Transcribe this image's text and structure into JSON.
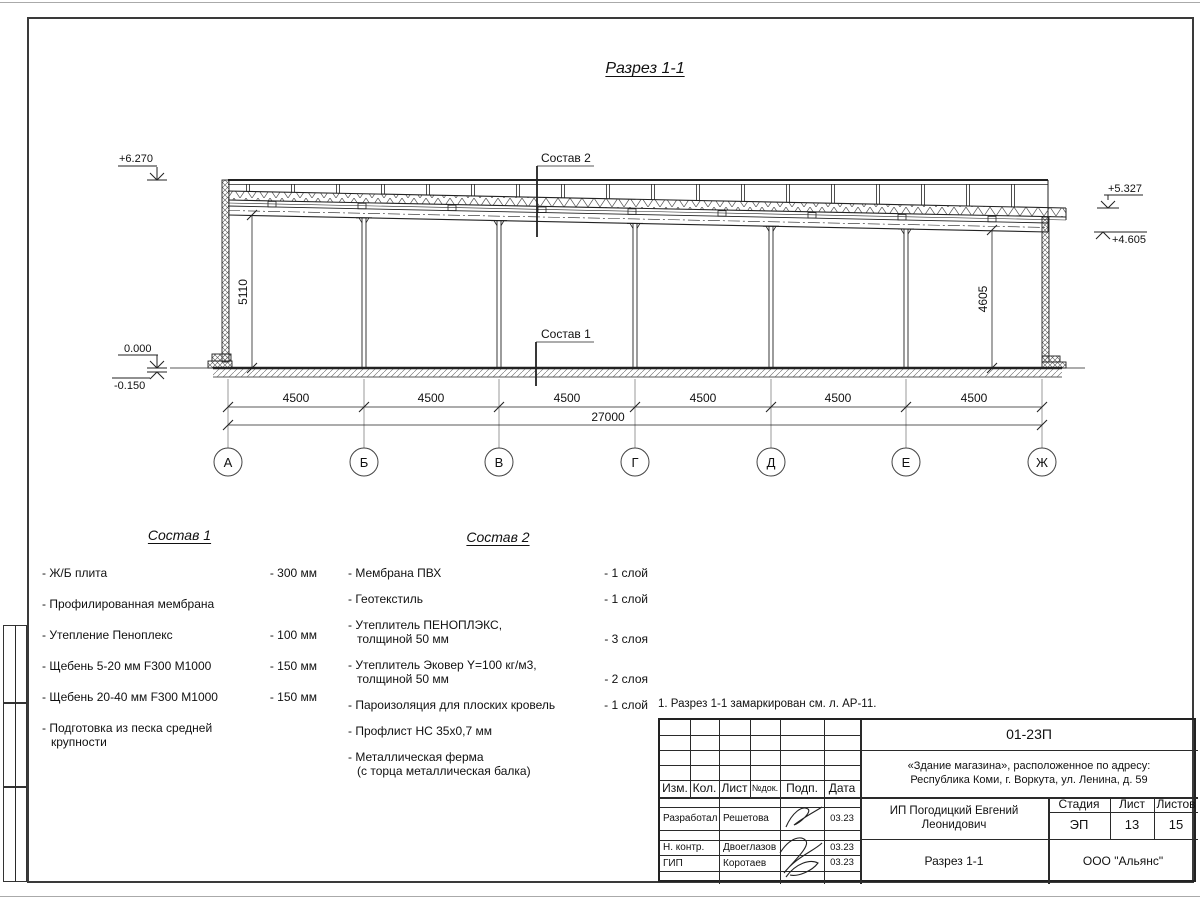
{
  "title": "Разрез 1-1",
  "section": {
    "leader1": "Состав 1",
    "leader2": "Состав 2",
    "elevations": {
      "top_left": "+6.270",
      "zero": "0.000",
      "minus": "-0.150",
      "right_upper": "+5.327",
      "right_lower": "+4.605"
    },
    "dims": {
      "bays": [
        "4500",
        "4500",
        "4500",
        "4500",
        "4500",
        "4500"
      ],
      "total": "27000",
      "height_left": "5110",
      "height_right": "4605"
    },
    "axes": [
      "А",
      "Б",
      "В",
      "Г",
      "Д",
      "Е",
      "Ж"
    ]
  },
  "sostav1": {
    "heading": "Состав 1",
    "items": [
      {
        "text": "- Ж/Б плита",
        "value": "- 300 мм"
      },
      {
        "text": "- Профилированная мембрана",
        "value": ""
      },
      {
        "text": "- Утепление Пеноплекс",
        "value": "- 100 мм"
      },
      {
        "text": "-  Щебень 5-20 мм F300 М1000",
        "value": "- 150 мм"
      },
      {
        "text": "-  Щебень 20-40 мм F300 М1000",
        "value": "- 150 мм"
      },
      {
        "text": "- Подготовка из песка средней\nкрупности",
        "value": ""
      }
    ]
  },
  "sostav2": {
    "heading": "Состав 2",
    "items": [
      {
        "text": "- Мембрана ПВХ",
        "value": "- 1 слой"
      },
      {
        "text": "- Геотекстиль",
        "value": "- 1 слой"
      },
      {
        "text": "- Утеплитель ПЕНОПЛЭКС,\nтолщиной 50 мм",
        "value": "- 3 слоя"
      },
      {
        "text": "- Утеплитель Эковер Y=100 кг/м3,\nтолщиной 50 мм",
        "value": "- 2 слоя"
      },
      {
        "text": "- Пароизоляция для плоских кровель",
        "value": "- 1 слой"
      },
      {
        "text": "- Профлист НС 35х0,7 мм",
        "value": ""
      },
      {
        "text": "- Металлическая ферма\n(с торца металлическая балка)",
        "value": ""
      }
    ]
  },
  "note": "1. Разрез 1-1 замаркирован см. л. АР-11.",
  "titleblock": {
    "doc_number": "01-23П",
    "project_line1": "«Здание магазина», расположенное по адресу:",
    "project_line2": "Республика Коми, г. Воркута, ул. Ленина, д. 59",
    "client": "ИП Погодицкий Евгений Леонидович",
    "drawing_title": "Разрез 1-1",
    "company": "ООО \"Альянс\"",
    "headers": {
      "izm": "Изм.",
      "kol": "Кол.",
      "list": "Лист",
      "ndok": "№док.",
      "podp": "Подп.",
      "data": "Дата",
      "stadia": "Стадия",
      "sheet": "Лист",
      "sheets": "Листов"
    },
    "stadia_value": "ЭП",
    "sheet_value": "13",
    "sheets_value": "15",
    "roles": [
      {
        "role": "Разработал",
        "name": "Решетова",
        "date": "03.23"
      },
      {
        "role": "Н. контр.",
        "name": "Двоеглазов",
        "date": "03.23"
      },
      {
        "role": "ГИП",
        "name": "Коротаев",
        "date": "03.23"
      }
    ]
  }
}
